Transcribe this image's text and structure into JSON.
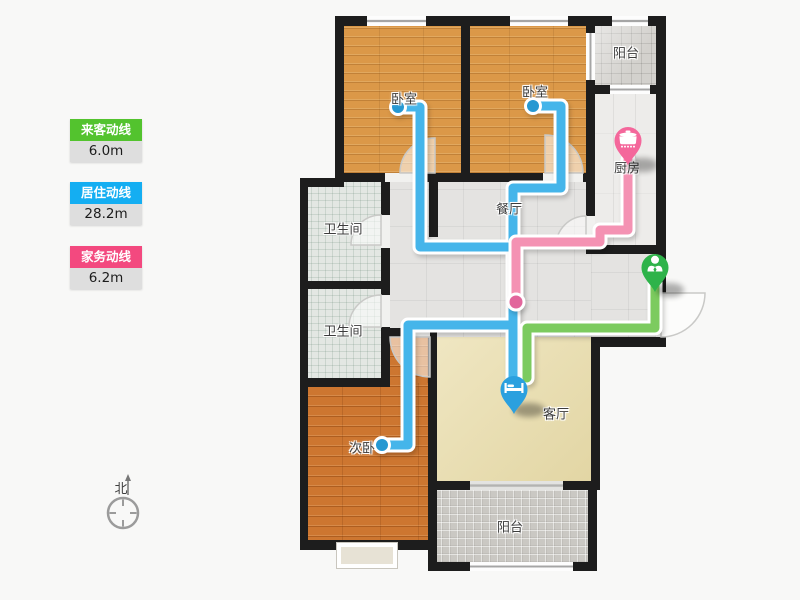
{
  "legend": {
    "items": [
      {
        "name": "visitor-route",
        "label": "来客动线",
        "length": "6.0m",
        "color": "#53c32e"
      },
      {
        "name": "resident-route",
        "label": "居住动线",
        "length": "28.2m",
        "color": "#14aef2"
      },
      {
        "name": "housework-route",
        "label": "家务动线",
        "length": "6.2m",
        "color": "#f3497f"
      }
    ]
  },
  "rooms": [
    {
      "id": "bedroom-1",
      "label": "卧室"
    },
    {
      "id": "bedroom-2",
      "label": "卧室"
    },
    {
      "id": "balcony-top",
      "label": "阳台"
    },
    {
      "id": "kitchen",
      "label": "厨房"
    },
    {
      "id": "dining-room",
      "label": "餐厅"
    },
    {
      "id": "bathroom-1",
      "label": "卫生间"
    },
    {
      "id": "bathroom-2",
      "label": "卫生间"
    },
    {
      "id": "secondary-bedroom",
      "label": "次卧"
    },
    {
      "id": "living-room",
      "label": "客厅"
    },
    {
      "id": "balcony-bottom",
      "label": "阳台"
    }
  ],
  "compass": {
    "label": "北"
  },
  "markers": [
    {
      "name": "entrance-marker",
      "icon": "person-icon",
      "color": "#2eb34a"
    },
    {
      "name": "living-room-marker",
      "icon": "bed-icon",
      "color": "#2ba0df"
    },
    {
      "name": "kitchen-marker",
      "icon": "pot-icon",
      "color": "#f4679b"
    }
  ],
  "route_colors": {
    "visitor": "#7ccb5f",
    "resident": "#45b5ea",
    "housework": "#f492b3"
  }
}
